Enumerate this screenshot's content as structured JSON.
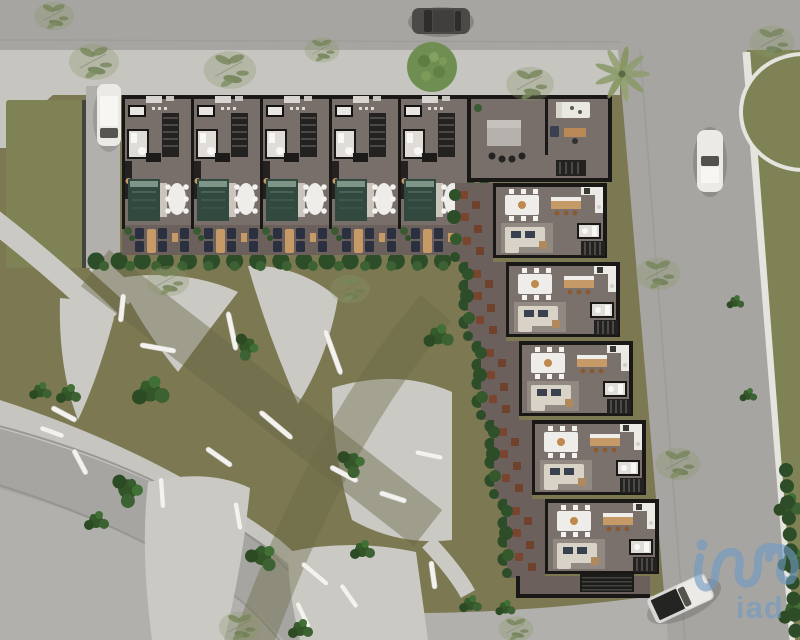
{
  "watermark": {
    "brand": "iad"
  },
  "site": {
    "description_names": [
      "aerial-site-plan-rendering",
      "l-shaped-residential-building",
      "landscaped-park",
      "perimeter-roads"
    ],
    "building": {
      "terraced_units_top_row": 5,
      "corner_unit_count": 1,
      "apartment_units_right_wing": 5
    },
    "vehicles": [
      {
        "name": "white-sedan-driveway"
      },
      {
        "name": "dark-sedan-top-road"
      },
      {
        "name": "white-sedan-right-road"
      },
      {
        "name": "white-pickup-truck-bottom"
      }
    ],
    "landscape_features": [
      "curved-paved-paths",
      "white-curved-benches",
      "shrub-clusters",
      "hedge-rows",
      "palm-tree",
      "round-tree",
      "sparse-trees",
      "lawn-panels"
    ]
  },
  "colors": {
    "grass": "#7b7852",
    "grassBright": "#7e8254",
    "grassBand": "#6b6947",
    "road": "#a6a5a1",
    "sidewalk": "#c6c5c0",
    "plaza": "#b1b0ac",
    "paving": "#cac9c4",
    "curb": "#e5e4df",
    "hedge": "#2d4c28",
    "shrub": "#3c6132",
    "treeRound": "#6f8f52",
    "treeSparse": "#87966a",
    "palm": "#93a172",
    "wall": "#191817",
    "floor": "#786e6a",
    "floorApt": "#7b716c",
    "terrace": "#6c605d",
    "rug": "#32493f",
    "tableWhite": "#efede9",
    "chairWhite": "#f4f3f0",
    "wood": "#c59a66",
    "woodDark": "#8a5a33",
    "lounge": "#2b3040",
    "sofa": "#d8d3c6",
    "cushion": "#394050",
    "stairs": "#232221",
    "stairStep": "#4c4a48",
    "bath": "#e0ddd8",
    "fixture": "#f7f7f5",
    "bench": "#f3f2ee",
    "carWhite": "#eceae6",
    "carDark": "#4b4a47",
    "logo": "#6f9ac4"
  }
}
